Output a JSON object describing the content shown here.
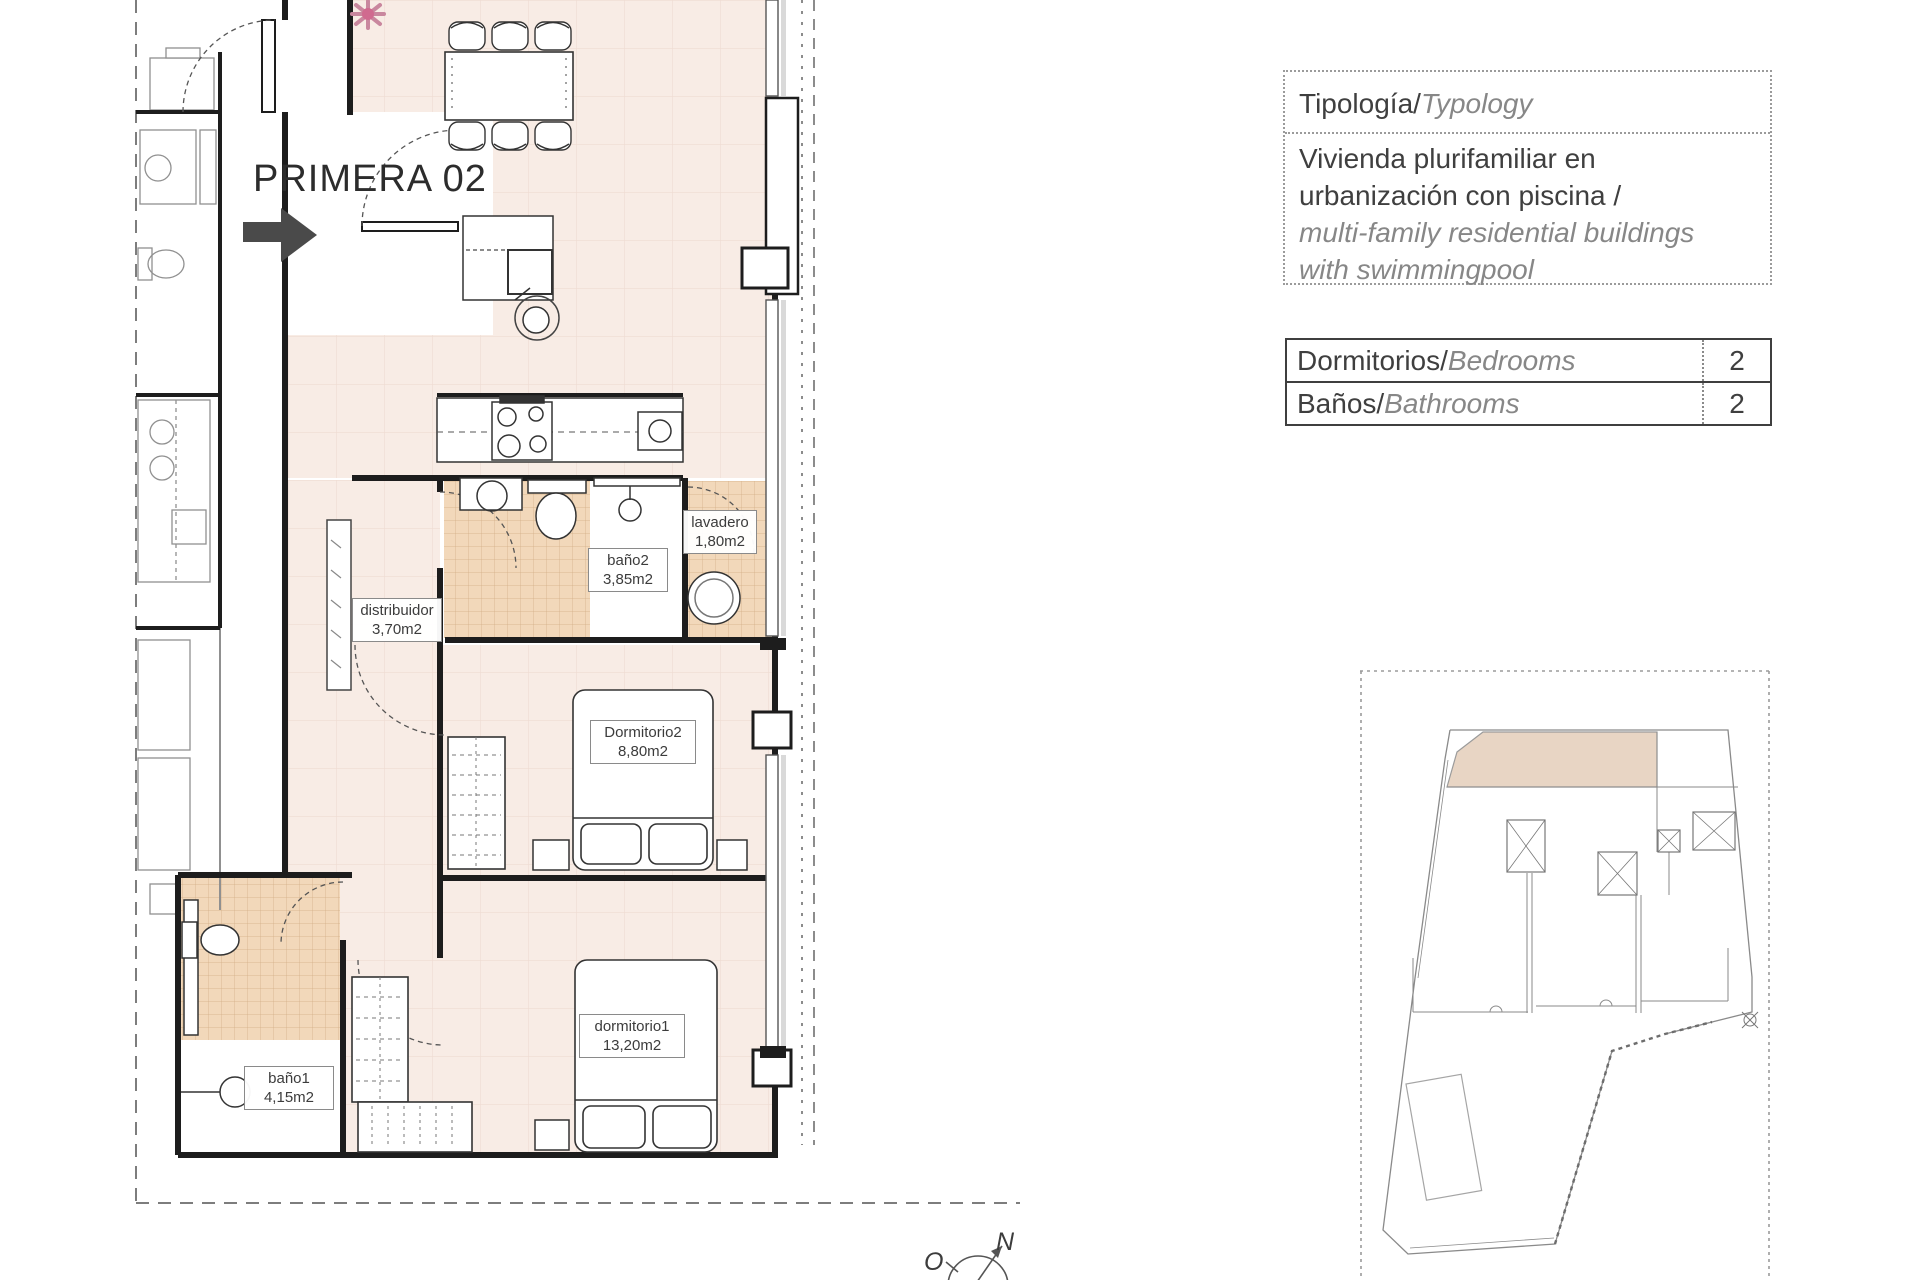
{
  "floor_plan": {
    "unit_label": "PRIMERA 02",
    "rooms": [
      {
        "name": "distribuidor",
        "area": "3,70m2"
      },
      {
        "name": "baño2",
        "area": "3,85m2"
      },
      {
        "name": "lavadero",
        "area": "1,80m2"
      },
      {
        "name": "Dormitorio2",
        "area": "8,80m2"
      },
      {
        "name": "dormitorio1",
        "area": "13,20m2"
      },
      {
        "name": "baño1",
        "area": "4,15m2"
      }
    ],
    "compass": {
      "north": "N",
      "west": "O"
    }
  },
  "typology_panel": {
    "title_es": "Tipología/",
    "title_en": "Typology",
    "desc_es": [
      "Vivienda plurifamiliar en",
      "urbanización con piscina  /"
    ],
    "desc_en": [
      "multi-family residential buildings",
      "with swimmingpool"
    ]
  },
  "specs_table": {
    "rows": [
      {
        "label_es": "Dormitorios/",
        "label_en": "Bedrooms",
        "value": "2"
      },
      {
        "label_es": "Baños/",
        "label_en": "Bathrooms",
        "value": "2"
      }
    ]
  },
  "colors": {
    "floor_pink": "#f8ece5",
    "tile_tan": "#f2d8ba",
    "site_highlight": "#e8d5c4",
    "wall_black": "#1d1d1d",
    "text_dark": "#3f3f3f",
    "text_italic_gray": "#878787",
    "arrow_gray": "#4a4a4a",
    "flower_pink": "#d06a8f"
  }
}
